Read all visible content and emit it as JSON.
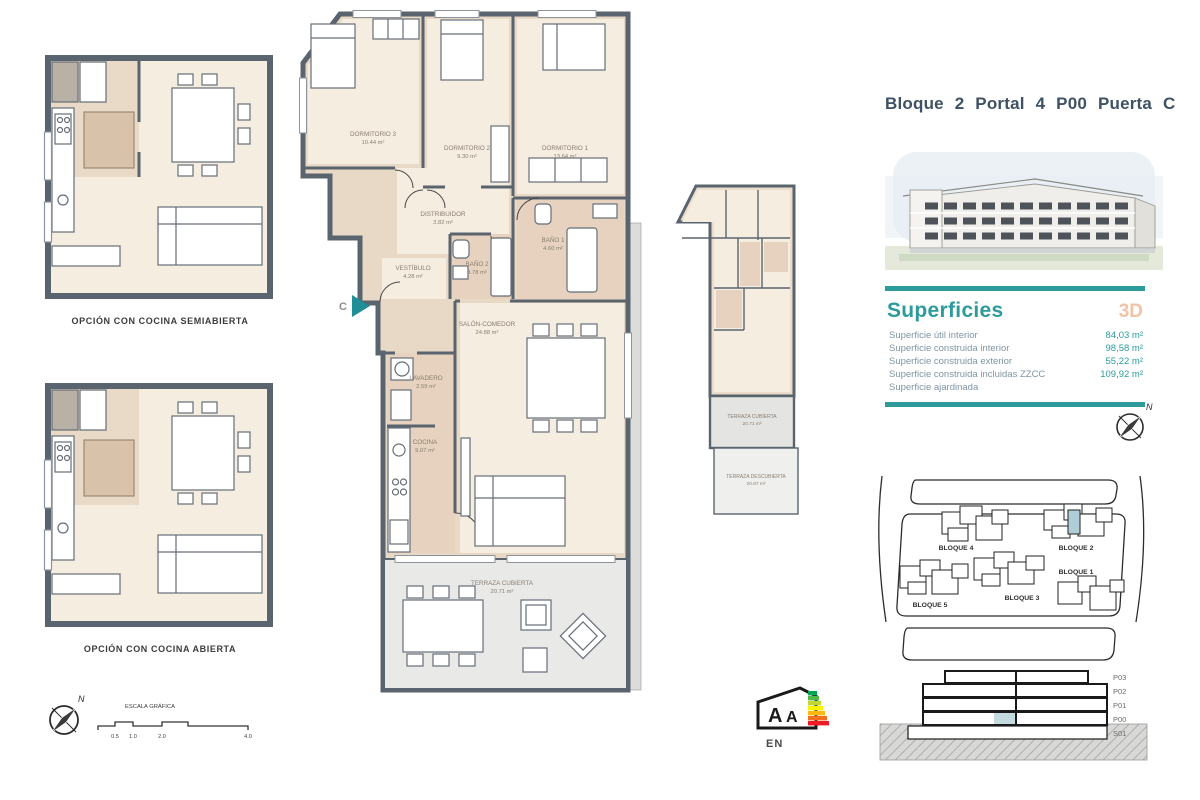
{
  "header": {
    "title": "Bloque 2 Portal 4 P00 Puerta C"
  },
  "superficies": {
    "heading": "Superficies",
    "badge_3d": "3D",
    "rows": [
      {
        "label": "Superficie útil interior",
        "value": "84,03 m²"
      },
      {
        "label": "Superficie construida interior",
        "value": "98,58 m²"
      },
      {
        "label": "Superficie construida exterior",
        "value": "55,22 m²"
      },
      {
        "label": "Superficie construida incluidas ZZCC",
        "value": "109,92 m²"
      },
      {
        "label": "Superficie ajardinada",
        "value": ""
      }
    ]
  },
  "main_plan": {
    "entrance": "C",
    "rooms": [
      {
        "name": "DORMITORIO 3",
        "area": "10.44 m²"
      },
      {
        "name": "DORMITORIO 2",
        "area": "9.30 m²"
      },
      {
        "name": "DORMITORIO 1",
        "area": "13.64 m²"
      },
      {
        "name": "DISTRIBUIDOR",
        "area": "3.82 m²"
      },
      {
        "name": "VESTÍBULO",
        "area": "4.28 m²"
      },
      {
        "name": "BAÑO 2",
        "area": "3.78 m²"
      },
      {
        "name": "BAÑO 1",
        "area": "4.60 m²"
      },
      {
        "name": "SALÓN-COMEDOR",
        "area": "24.88 m²"
      },
      {
        "name": "LAVADERO",
        "area": "2.59 m²"
      },
      {
        "name": "COCINA",
        "area": "9.07 m²"
      },
      {
        "name": "TERRAZA CUBIERTA",
        "area": "20.71 m²"
      }
    ]
  },
  "mini_plan": {
    "terraza_cubierta": {
      "name": "TERRAZA CUBIERTA",
      "area": "20.71 m²"
    },
    "terraza_descubierta": {
      "name": "TERRAZA DESCUBIERTA",
      "area": "20.87 m²"
    }
  },
  "options": {
    "semiabierta": "OPCIÓN CON COCINA SEMIABIERTA",
    "abierta": "OPCIÓN CON COCINA ABIERTA"
  },
  "scale_bar": {
    "label": "ESCALA GRÁFICA",
    "ticks": [
      "0.5",
      "1.0",
      "2.0",
      "4.0"
    ]
  },
  "compass": {
    "north": "N"
  },
  "site_plan": {
    "blocks": [
      {
        "label": "BLOQUE 4"
      },
      {
        "label": "BLOQUE 2"
      },
      {
        "label": "BLOQUE 1"
      },
      {
        "label": "BLOQUE 3"
      },
      {
        "label": "BLOQUE 5"
      }
    ]
  },
  "section": {
    "levels": [
      "P03",
      "P02",
      "P01",
      "P00",
      "S01"
    ]
  },
  "energy_label": {
    "letter_1": "A",
    "letter_2": "A",
    "lang": "EN"
  },
  "colors": {
    "teal": "#2d9b9b",
    "peach_3d": "#f2c2a6",
    "title_blue": "#3f5265",
    "wall_dark": "#5a646e",
    "beige_wall": "#e8d8c6",
    "beige_floor": "#f5ede0",
    "tile": "#e6d2bf",
    "terrace_gray": "#e9e9e7",
    "highlight_teal": "#aecdd4"
  }
}
